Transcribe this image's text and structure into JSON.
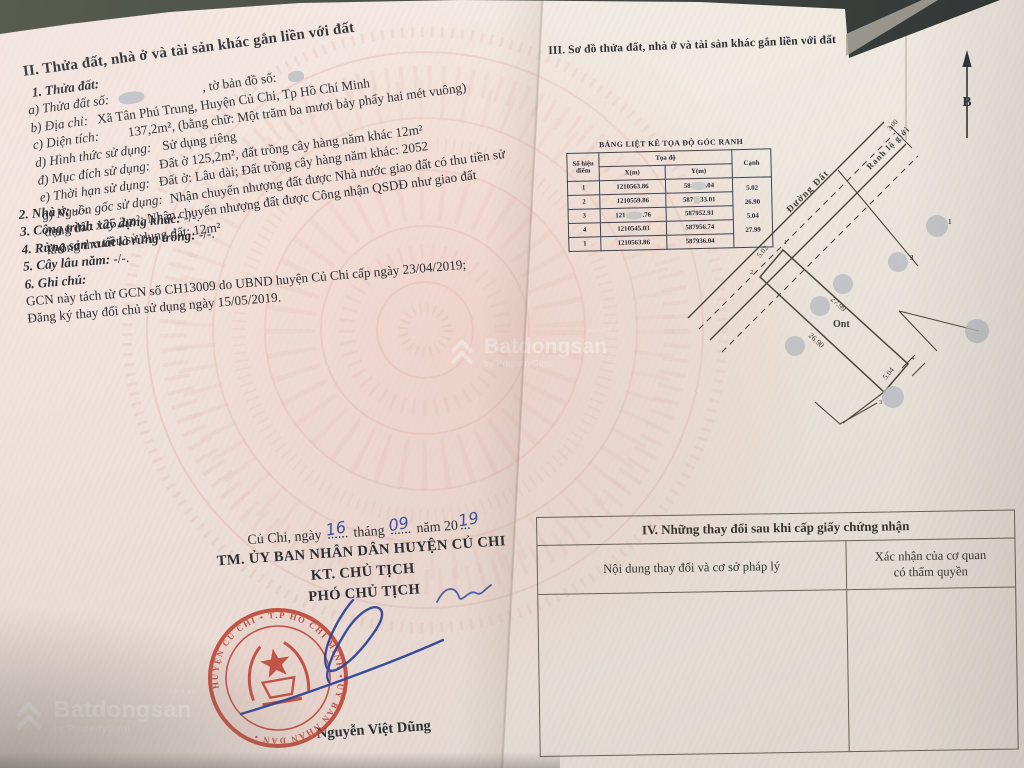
{
  "page_left": {
    "section2": {
      "title": "II. Thửa đất, nhà ở và tài sản khác gắn liền với đất",
      "item1_heading": "1. Thửa đất:",
      "a_label": "a) Thửa đất số:",
      "a_mid": ", tờ bản đồ số:",
      "b_label": "b) Địa chỉ:",
      "b_value": "Xã Tân Phú Trung, Huyện Củ Chi, Tp Hồ Chí Minh",
      "c_label": "c) Diện tích:",
      "c_value": "137,2m², (bằng chữ: Một trăm ba mươi bảy phẩy hai mét vuông)",
      "d_label": "d) Hình thức sử dụng:",
      "d_value": "Sử dụng riêng",
      "dd_label": "đ) Mục đích sử dụng:",
      "dd_value": "Đất ở 125,2m², đất trồng cây hàng năm khác 12m²",
      "e_label": "e) Thời hạn sử dụng:",
      "e_value": "Đất ở: Lâu dài; Đất trồng cây hàng năm khác: 2052",
      "g_label": "g) Nguồn gốc sử dụng:",
      "g_line1": "Nhận chuyển nhượng đất được Nhà nước giao đất có thu tiền sử",
      "g_line2": "dụng đất: 125,2m²; Nhận chuyển nhượng đất được Công nhận QSDĐ như giao đất",
      "g_line3": "không thu tiền sử dụng đất: 12m²"
    },
    "items": {
      "i2_label": "2. Nhà ở:",
      "i2_value": "-/-.",
      "i3_label": "3. Công trình xây dựng khác:",
      "i3_value": "-/-.",
      "i4_label": "4. Rừng sản xuất là rừng trồng:",
      "i4_value": "-/-.",
      "i5_label": "5. Cây lâu năm:",
      "i5_value": "-/-.",
      "i6_label": "6. Ghi chú:",
      "note_line1": "GCN này tách từ GCN số CH13009 do UBND huyện Củ Chi cấp ngày 23/04/2019;",
      "note_line2": "Đăng ký thay đổi chủ sử dụng ngày 15/05/2019."
    },
    "signature": {
      "place_prefix": "Củ Chi, ngày",
      "day": "16",
      "dots1": "......",
      "month_label": "tháng",
      "month": "09",
      "dots2": "......",
      "year_label": "năm 20",
      "year": "19",
      "dots3": "...",
      "line1": "TM. ỦY BAN NHÂN DÂN HUYỆN CỦ CHI",
      "line2": "KT. CHỦ TỊCH",
      "line3": "PHÓ CHỦ TỊCH",
      "signer_name": "Nguyễn Việt Dũng",
      "seal_ring_text": "HUYỆN CỦ CHI • T.P HỒ CHÍ MINH • ỦY BAN NHÂN DÂN •"
    }
  },
  "page_right": {
    "section3_title": "III. Sơ đồ thửa đất, nhà ở và tài sản khác gắn liền với đất",
    "north_label": "B",
    "coord_table": {
      "title": "BẢNG LIỆT KÊ TỌA ĐỘ GÓC RANH",
      "col_point_1": "Số hiệu",
      "col_point_2": "điểm",
      "col_coord": "Tọa độ",
      "col_x": "X(m)",
      "col_y": "Y(m)",
      "col_edge": "Cạnh",
      "rows": [
        {
          "point": "1",
          "x": "1210563.86",
          "y_pre": "58",
          "y_post": ".04"
        },
        {
          "point": "2",
          "x": "1210559.86",
          "y_pre": "587",
          "y_post": "33.01"
        },
        {
          "point": "3",
          "x_pre": "121",
          "x_post": ".76",
          "y": "587952.91"
        },
        {
          "point": "4",
          "x": "1210545.03",
          "y": "587956.74"
        },
        {
          "point": "1",
          "x": "1210563.86",
          "y": "587936.04"
        }
      ],
      "edges": [
        "5.02",
        "26.90",
        "5.04",
        "27.99"
      ]
    },
    "sketch": {
      "road_label": "Đường Đất",
      "boundary_label": "Ranh lộ giới",
      "dim_top": "3.00",
      "edge_12": "5.02",
      "edge_23": "26.90",
      "edge_34": "5.04",
      "edge_41": "27.99",
      "land_type": "Ont",
      "p1": "1",
      "p2": "2",
      "p3": "3",
      "p4": "4"
    },
    "section4": {
      "title": "IV. Những thay đổi sau khi cấp giấy chứng nhận",
      "col1": "Nội dung thay đổi và cơ sở pháp lý",
      "col2_line1": "Xác nhận của cơ quan",
      "col2_line2": "có thẩm quyền"
    }
  },
  "watermark": {
    "brand": "Batdongsan",
    "suffix": "com.vn",
    "byline": "by PropertyGuru"
  },
  "colors": {
    "seal_red": "#c23a2b",
    "ink_blue": "#2f479e",
    "paper_pink": "#f2e3dc",
    "paper_cream": "#efe9e0",
    "backdrop": "#474c44"
  }
}
